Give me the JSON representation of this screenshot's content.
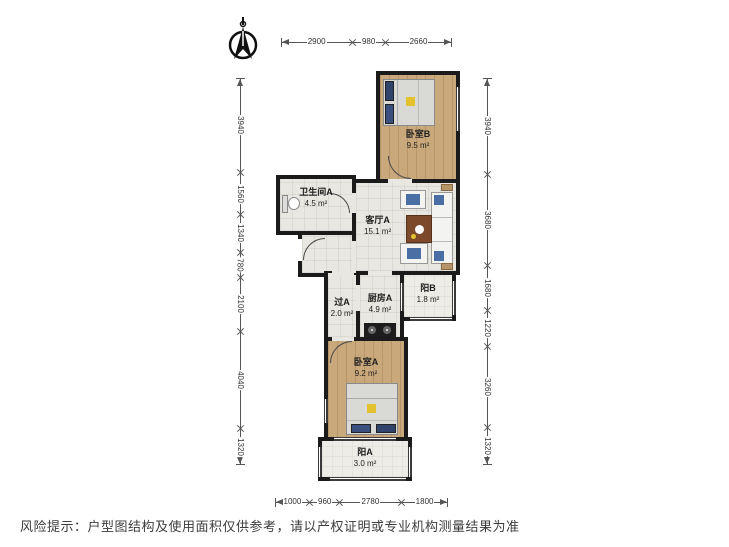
{
  "disclaimer": "风险提示：户型图结构及使用面积仅供参考，请以产权证明或专业机构测量结果为准",
  "rooms": [
    {
      "name": "卧室B",
      "area": "9.5 m²"
    },
    {
      "name": "卫生间A",
      "area": "4.5 m²"
    },
    {
      "name": "客厅A",
      "area": "15.1 m²"
    },
    {
      "name": "过A",
      "area": "2.0 m²"
    },
    {
      "name": "厨房A",
      "area": "4.9 m²"
    },
    {
      "name": "阳B",
      "area": "1.8 m²"
    },
    {
      "name": "卧室A",
      "area": "9.2 m²"
    },
    {
      "name": "阳A",
      "area": "3.0 m²"
    }
  ],
  "dimensions": {
    "top": [
      2900,
      980,
      2660
    ],
    "left": [
      3940,
      1560,
      1340,
      780,
      2100,
      4040,
      1320
    ],
    "right": [
      3940,
      3680,
      1680,
      1220,
      3260,
      1320
    ],
    "bottom": [
      1000,
      960,
      2780,
      1800
    ]
  },
  "colors": {
    "wall": "#1b1b1b",
    "wood_floor": "#c9a87c",
    "tile_floor": "#e9e7e1",
    "balcony_floor": "#edece7",
    "dimension_line": "#555555",
    "accent_pillow": "#31436b",
    "accent_blanket": "#e3c22f",
    "sofa_cushion": "#4a6fa5",
    "coffee_table": "#7c4a2a"
  }
}
